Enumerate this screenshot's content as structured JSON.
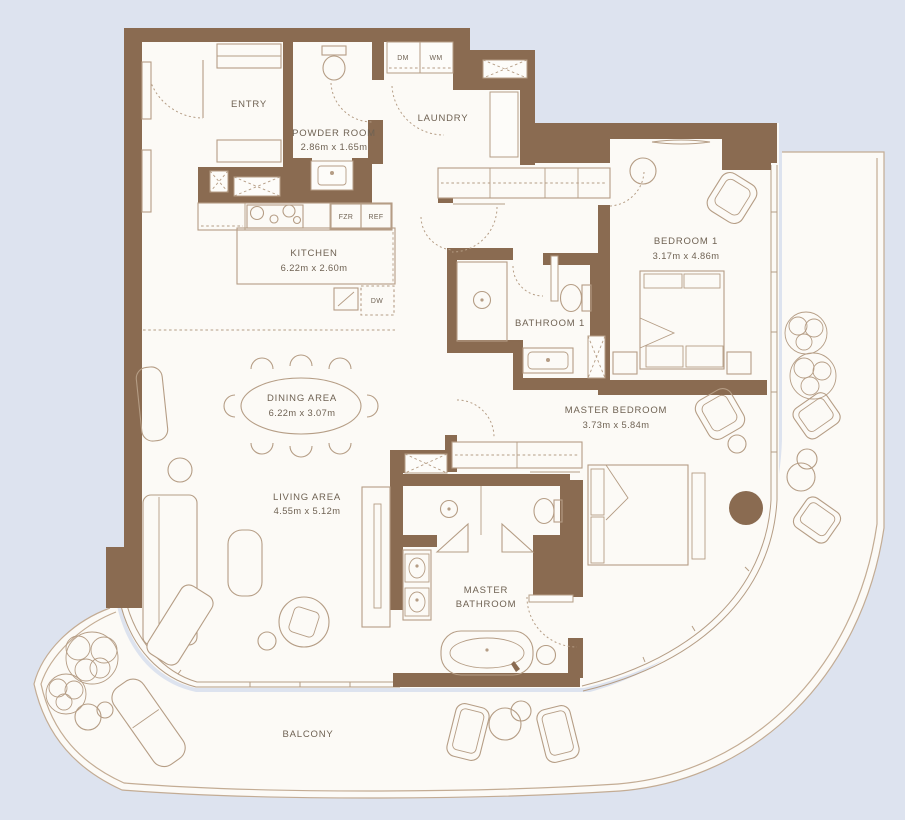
{
  "plan": {
    "title": "Apartment floor plan",
    "colors": {
      "background": "#dde3ef",
      "wall": "#8a6b51",
      "floor": "#fcfaf6",
      "furniture": "#b59d85",
      "text": "#6f6253",
      "parapet": "#c3ac94"
    },
    "rooms": {
      "entry": {
        "name": "ENTRY"
      },
      "powder": {
        "name": "POWDER ROOM",
        "dims": "2.86m x 1.65m"
      },
      "laundry": {
        "name": "LAUNDRY"
      },
      "kitchen": {
        "name": "KITCHEN",
        "dims": "6.22m x 2.60m"
      },
      "bedroom1": {
        "name": "BEDROOM 1",
        "dims": "3.17m x 4.86m"
      },
      "bathroom1": {
        "name": "BATHROOM 1"
      },
      "dining": {
        "name": "DINING AREA",
        "dims": "6.22m x 3.07m"
      },
      "living": {
        "name": "LIVING AREA",
        "dims": "4.55m x 5.12m"
      },
      "master_bedroom": {
        "name": "MASTER BEDROOM",
        "dims": "3.73m x 5.84m"
      },
      "master_bathroom": {
        "line1": "MASTER",
        "line2": "BATHROOM"
      },
      "balcony": {
        "name": "BALCONY"
      }
    },
    "appliances": {
      "dm": "DM",
      "wm": "WM",
      "fzr": "FZR",
      "ref": "REF",
      "dw": "DW"
    }
  }
}
